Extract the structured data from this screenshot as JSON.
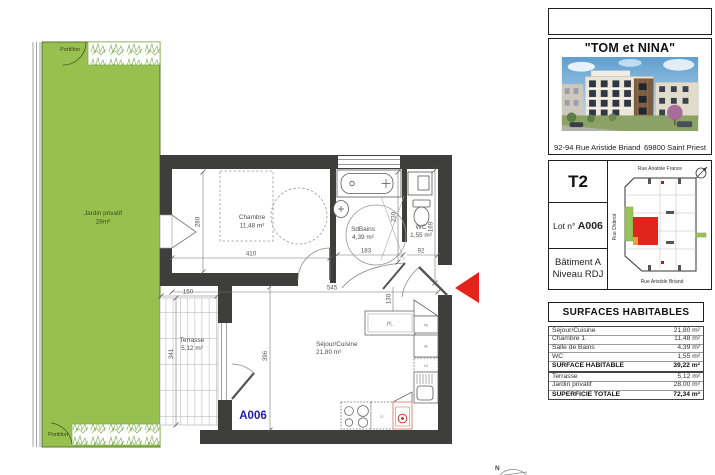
{
  "plan": {
    "garden": {
      "label_line1": "Jardin privatif",
      "label_line2": "28m²",
      "portillon_top": "Portillon",
      "portillon_bottom": "Portillon"
    },
    "rooms": {
      "chambre": {
        "name": "Chambre",
        "area": "11,48 m²"
      },
      "salle_de_bains": {
        "name": "SdBains",
        "area": "4,39 m²"
      },
      "wc": {
        "name": "WC",
        "area": "1,55 m²"
      },
      "sejour_cuisine": {
        "name": "Séjour/Cuisine",
        "area": "21,80 m²"
      },
      "terrasse": {
        "name": "Terrasse",
        "area": "5,12 m²"
      }
    },
    "dimensions": {
      "chambre_h": "280",
      "chambre_w": "410",
      "sdb_h": "230",
      "sdb_w": "183",
      "wc_w": "92",
      "wc_h": "169",
      "sejour_w": "545",
      "kitchen_h": "130",
      "sejour_h": "396",
      "terrasse_h": "341",
      "terrasse_w": "150"
    },
    "kitchen_labels": {
      "placard": "PL",
      "fe": "FE",
      "fridge": "R",
      "dishwasher": "LV",
      "washer": "LL"
    },
    "lot_label": "A006",
    "north_label": "N"
  },
  "panel": {
    "program_title": "\"TOM et NINA\"",
    "address_street": "92-94 Rue Aristide Briand",
    "address_city": "69800 Saint Priest",
    "unit_type": "T2",
    "lot_prefix": "Lot n°",
    "lot_number": "A006",
    "building_name": "Bâtiment A",
    "level": "Niveau RDJ",
    "siteplan": {
      "street_top": "Rue Anatole France",
      "street_left": "Rue Diderot",
      "street_bottom": "Rue Aristide Briand"
    },
    "surfaces": {
      "title": "SURFACES HABITABLES",
      "rows": [
        {
          "label": "Séjour/Cuisine",
          "value": "21,80 m²"
        },
        {
          "label": "Chambre 1",
          "value": "11,48 m²"
        },
        {
          "label": "Salle de Bains",
          "value": "4,39 m²"
        },
        {
          "label": "WC",
          "value": "1,55 m²"
        },
        {
          "label": "SURFACE HABITABLE",
          "value": "39,22 m²"
        }
      ],
      "rows2": [
        {
          "label": "Terrasse",
          "value": "5,12 m²"
        },
        {
          "label": "Jardin privatif",
          "value": "28,00 m²"
        },
        {
          "label": "SUPERFICIE TOTALE",
          "value": "72,34 m²"
        }
      ]
    }
  },
  "colors": {
    "garden_green": "#97c04f",
    "wall_dark": "#3e3e3c",
    "accent_red": "#e5231b",
    "lot_blue": "#1b1bb5"
  }
}
